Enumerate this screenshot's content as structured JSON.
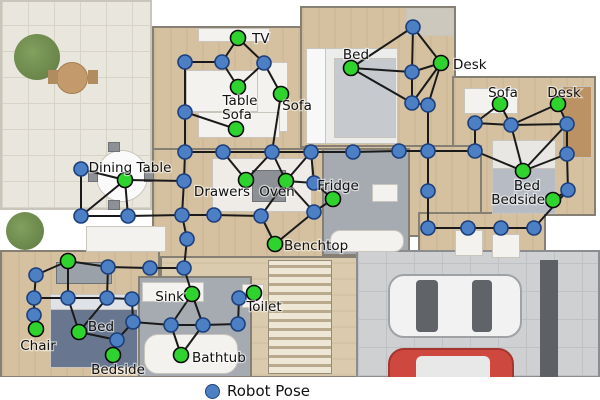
{
  "legend": {
    "label": "Robot Pose"
  },
  "colors": {
    "pose_fill": "#4d7fc4",
    "pose_stroke": "#1c3f7c",
    "landmark_fill": "#2ed32e",
    "landmark_stroke": "#0a0a0a",
    "edge": "#1a1a1a",
    "label_color": "#111111"
  },
  "graph": {
    "nodes": [
      {
        "id": "p1",
        "x": 185,
        "y": 62,
        "type": "pose"
      },
      {
        "id": "p2",
        "x": 222,
        "y": 62,
        "type": "pose"
      },
      {
        "id": "p3",
        "x": 264,
        "y": 63,
        "type": "pose"
      },
      {
        "id": "p4",
        "x": 185,
        "y": 112,
        "type": "pose"
      },
      {
        "id": "p5",
        "x": 81,
        "y": 169,
        "type": "pose"
      },
      {
        "id": "p6",
        "x": 81,
        "y": 216,
        "type": "pose"
      },
      {
        "id": "p7",
        "x": 128,
        "y": 216,
        "type": "pose"
      },
      {
        "id": "p8",
        "x": 185,
        "y": 152,
        "type": "pose"
      },
      {
        "id": "p9",
        "x": 184,
        "y": 181,
        "type": "pose"
      },
      {
        "id": "p10",
        "x": 182,
        "y": 215,
        "type": "pose"
      },
      {
        "id": "p11",
        "x": 187,
        "y": 239,
        "type": "pose"
      },
      {
        "id": "p12",
        "x": 150,
        "y": 268,
        "type": "pose"
      },
      {
        "id": "p13",
        "x": 184,
        "y": 268,
        "type": "pose"
      },
      {
        "id": "p14",
        "x": 223,
        "y": 152,
        "type": "pose"
      },
      {
        "id": "p15",
        "x": 272,
        "y": 152,
        "type": "pose"
      },
      {
        "id": "p16",
        "x": 311,
        "y": 152,
        "type": "pose"
      },
      {
        "id": "p17",
        "x": 353,
        "y": 152,
        "type": "pose"
      },
      {
        "id": "p18",
        "x": 399,
        "y": 151,
        "type": "pose"
      },
      {
        "id": "p19",
        "x": 428,
        "y": 151,
        "type": "pose"
      },
      {
        "id": "p20",
        "x": 475,
        "y": 151,
        "type": "pose"
      },
      {
        "id": "p21",
        "x": 214,
        "y": 215,
        "type": "pose"
      },
      {
        "id": "p22",
        "x": 261,
        "y": 216,
        "type": "pose"
      },
      {
        "id": "p23",
        "x": 314,
        "y": 183,
        "type": "pose"
      },
      {
        "id": "p24",
        "x": 314,
        "y": 212,
        "type": "pose"
      },
      {
        "id": "p25",
        "x": 171,
        "y": 325,
        "type": "pose"
      },
      {
        "id": "p26",
        "x": 203,
        "y": 325,
        "type": "pose"
      },
      {
        "id": "p27",
        "x": 238,
        "y": 324,
        "type": "pose"
      },
      {
        "id": "p28",
        "x": 239,
        "y": 298,
        "type": "pose"
      },
      {
        "id": "p29",
        "x": 36,
        "y": 275,
        "type": "pose"
      },
      {
        "id": "p30",
        "x": 108,
        "y": 267,
        "type": "pose"
      },
      {
        "id": "p31",
        "x": 34,
        "y": 298,
        "type": "pose"
      },
      {
        "id": "p32",
        "x": 68,
        "y": 298,
        "type": "pose"
      },
      {
        "id": "p33",
        "x": 107,
        "y": 298,
        "type": "pose"
      },
      {
        "id": "p34",
        "x": 132,
        "y": 299,
        "type": "pose"
      },
      {
        "id": "p35",
        "x": 34,
        "y": 315,
        "type": "pose"
      },
      {
        "id": "p36",
        "x": 133,
        "y": 322,
        "type": "pose"
      },
      {
        "id": "p37",
        "x": 117,
        "y": 340,
        "type": "pose"
      },
      {
        "id": "p38",
        "x": 413,
        "y": 27,
        "type": "pose"
      },
      {
        "id": "p39",
        "x": 412,
        "y": 72,
        "type": "pose"
      },
      {
        "id": "p40",
        "x": 412,
        "y": 103,
        "type": "pose"
      },
      {
        "id": "p41",
        "x": 428,
        "y": 105,
        "type": "pose"
      },
      {
        "id": "p42",
        "x": 475,
        "y": 123,
        "type": "pose"
      },
      {
        "id": "p43",
        "x": 511,
        "y": 125,
        "type": "pose"
      },
      {
        "id": "p44",
        "x": 567,
        "y": 124,
        "type": "pose"
      },
      {
        "id": "p45",
        "x": 567,
        "y": 154,
        "type": "pose"
      },
      {
        "id": "p46",
        "x": 568,
        "y": 190,
        "type": "pose"
      },
      {
        "id": "p47",
        "x": 428,
        "y": 191,
        "type": "pose"
      },
      {
        "id": "p48",
        "x": 428,
        "y": 228,
        "type": "pose"
      },
      {
        "id": "p49",
        "x": 468,
        "y": 228,
        "type": "pose"
      },
      {
        "id": "p50",
        "x": 501,
        "y": 228,
        "type": "pose"
      },
      {
        "id": "p51",
        "x": 534,
        "y": 228,
        "type": "pose"
      },
      {
        "id": "L1",
        "x": 238,
        "y": 38,
        "type": "landmark",
        "label": "TV",
        "lx": 252,
        "ly": 43,
        "anchor": "start"
      },
      {
        "id": "L2",
        "x": 238,
        "y": 87,
        "type": "landmark",
        "label": "Table",
        "lx": 240,
        "ly": 105,
        "anchor": "middle"
      },
      {
        "id": "L3",
        "x": 281,
        "y": 94,
        "type": "landmark",
        "label": "Sofa",
        "lx": 297,
        "ly": 110,
        "anchor": "middle"
      },
      {
        "id": "L4",
        "x": 236,
        "y": 129,
        "type": "landmark",
        "label": "Sofa",
        "lx": 237,
        "ly": 119,
        "anchor": "middle"
      },
      {
        "id": "L5",
        "x": 125,
        "y": 180,
        "type": "landmark",
        "label": "Dining Table",
        "lx": 130,
        "ly": 172,
        "anchor": "middle"
      },
      {
        "id": "L6",
        "x": 246,
        "y": 180,
        "type": "landmark",
        "label": "Drawers",
        "lx": 222,
        "ly": 196,
        "anchor": "middle"
      },
      {
        "id": "L7",
        "x": 286,
        "y": 181,
        "type": "landmark",
        "label": "Oven",
        "lx": 277,
        "ly": 196,
        "anchor": "middle"
      },
      {
        "id": "L8",
        "x": 333,
        "y": 199,
        "type": "landmark",
        "label": "Fridge",
        "lx": 338,
        "ly": 190,
        "anchor": "middle"
      },
      {
        "id": "L9",
        "x": 275,
        "y": 244,
        "type": "landmark",
        "label": "Benchtop",
        "lx": 284,
        "ly": 250,
        "anchor": "start"
      },
      {
        "id": "L10",
        "x": 192,
        "y": 294,
        "type": "landmark",
        "label": "Sink",
        "lx": 184,
        "ly": 301,
        "anchor": "end"
      },
      {
        "id": "L11",
        "x": 254,
        "y": 293,
        "type": "landmark",
        "label": "Toilet",
        "lx": 264,
        "ly": 311,
        "anchor": "middle"
      },
      {
        "id": "L12",
        "x": 181,
        "y": 355,
        "type": "landmark",
        "label": "Bathtub",
        "lx": 192,
        "ly": 362,
        "anchor": "start"
      },
      {
        "id": "L13",
        "x": 68,
        "y": 261,
        "type": "landmark",
        "label": "",
        "lx": 0,
        "ly": 0,
        "anchor": "middle"
      },
      {
        "id": "L14",
        "x": 36,
        "y": 329,
        "type": "landmark",
        "label": "Chair",
        "lx": 38,
        "ly": 350,
        "anchor": "middle"
      },
      {
        "id": "L15",
        "x": 79,
        "y": 332,
        "type": "landmark",
        "label": "Bed",
        "lx": 101,
        "ly": 331,
        "anchor": "middle"
      },
      {
        "id": "L16",
        "x": 113,
        "y": 355,
        "type": "landmark",
        "label": "Bedside",
        "lx": 118,
        "ly": 374,
        "anchor": "middle"
      },
      {
        "id": "L17",
        "x": 351,
        "y": 68,
        "type": "landmark",
        "label": "Bed",
        "lx": 356,
        "ly": 59,
        "anchor": "middle"
      },
      {
        "id": "L18",
        "x": 441,
        "y": 63,
        "type": "landmark",
        "label": "Desk",
        "lx": 453,
        "ly": 69,
        "anchor": "start"
      },
      {
        "id": "L19",
        "x": 500,
        "y": 104,
        "type": "landmark",
        "label": "Sofa",
        "lx": 503,
        "ly": 97,
        "anchor": "middle"
      },
      {
        "id": "L20",
        "x": 558,
        "y": 104,
        "type": "landmark",
        "label": "Desk",
        "lx": 564,
        "ly": 97,
        "anchor": "middle"
      },
      {
        "id": "L21",
        "x": 523,
        "y": 171,
        "type": "landmark",
        "label": "Bed",
        "lx": 527,
        "ly": 190,
        "anchor": "middle"
      },
      {
        "id": "L22",
        "x": 553,
        "y": 200,
        "type": "landmark",
        "label": "Bedside",
        "lx": 545,
        "ly": 204,
        "anchor": "end"
      }
    ],
    "edges": [
      [
        "p2",
        "L1"
      ],
      [
        "p3",
        "L1"
      ],
      [
        "p1",
        "p2"
      ],
      [
        "p2",
        "L2"
      ],
      [
        "p3",
        "L2"
      ],
      [
        "p3",
        "L3"
      ],
      [
        "p1",
        "p4"
      ],
      [
        "p4",
        "L4"
      ],
      [
        "p4",
        "p8"
      ],
      [
        "L3",
        "p15"
      ],
      [
        "p5",
        "L5"
      ],
      [
        "p5",
        "p6"
      ],
      [
        "p6",
        "p7"
      ],
      [
        "p6",
        "L5"
      ],
      [
        "p7",
        "L5"
      ],
      [
        "L5",
        "p9"
      ],
      [
        "p7",
        "p10"
      ],
      [
        "p8",
        "p9"
      ],
      [
        "p9",
        "p10"
      ],
      [
        "p10",
        "p11"
      ],
      [
        "p11",
        "p13"
      ],
      [
        "p8",
        "p14"
      ],
      [
        "p14",
        "p15"
      ],
      [
        "p15",
        "p16"
      ],
      [
        "p16",
        "p17"
      ],
      [
        "p17",
        "p18"
      ],
      [
        "p18",
        "p19"
      ],
      [
        "p19",
        "p20"
      ],
      [
        "p14",
        "L6"
      ],
      [
        "p15",
        "L6"
      ],
      [
        "p15",
        "L7"
      ],
      [
        "p16",
        "L7"
      ],
      [
        "L7",
        "p23"
      ],
      [
        "L7",
        "p22"
      ],
      [
        "L7",
        "p24"
      ],
      [
        "p16",
        "p23"
      ],
      [
        "p23",
        "L8"
      ],
      [
        "p24",
        "L8"
      ],
      [
        "p22",
        "L9"
      ],
      [
        "p24",
        "L9"
      ],
      [
        "p10",
        "p21"
      ],
      [
        "p21",
        "p22"
      ],
      [
        "p12",
        "p13"
      ],
      [
        "p12",
        "p30"
      ],
      [
        "p13",
        "L10"
      ],
      [
        "L10",
        "p25"
      ],
      [
        "L10",
        "p26"
      ],
      [
        "p25",
        "p26"
      ],
      [
        "p25",
        "L12"
      ],
      [
        "p26",
        "L12"
      ],
      [
        "p26",
        "p27"
      ],
      [
        "p27",
        "p28"
      ],
      [
        "p28",
        "L11"
      ],
      [
        "p36",
        "p25"
      ],
      [
        "L13",
        "p29"
      ],
      [
        "L13",
        "p30"
      ],
      [
        "L13",
        "p32"
      ],
      [
        "p29",
        "p31"
      ],
      [
        "p31",
        "p32"
      ],
      [
        "p32",
        "p33"
      ],
      [
        "p33",
        "p30"
      ],
      [
        "p33",
        "p34"
      ],
      [
        "p31",
        "p35"
      ],
      [
        "p35",
        "L14"
      ],
      [
        "p32",
        "L15"
      ],
      [
        "p33",
        "L15"
      ],
      [
        "p34",
        "p36"
      ],
      [
        "p36",
        "p37"
      ],
      [
        "p37",
        "L16"
      ],
      [
        "L15",
        "p37"
      ],
      [
        "L17",
        "p38"
      ],
      [
        "L17",
        "p39"
      ],
      [
        "L17",
        "p40"
      ],
      [
        "p38",
        "p39"
      ],
      [
        "p38",
        "L18"
      ],
      [
        "p39",
        "L18"
      ],
      [
        "p39",
        "p40"
      ],
      [
        "p40",
        "L18"
      ],
      [
        "p40",
        "p41"
      ],
      [
        "p41",
        "L18"
      ],
      [
        "p41",
        "p19"
      ],
      [
        "L19",
        "p42"
      ],
      [
        "L19",
        "p43"
      ],
      [
        "p42",
        "p43"
      ],
      [
        "p43",
        "L20"
      ],
      [
        "p43",
        "p44"
      ],
      [
        "L20",
        "p44"
      ],
      [
        "p42",
        "p20"
      ],
      [
        "p20",
        "L21"
      ],
      [
        "p43",
        "L21"
      ],
      [
        "p44",
        "L21"
      ],
      [
        "p45",
        "L21"
      ],
      [
        "p44",
        "p45"
      ],
      [
        "p45",
        "p46"
      ],
      [
        "p46",
        "L22"
      ],
      [
        "p46",
        "p51"
      ],
      [
        "p19",
        "p47"
      ],
      [
        "p47",
        "p48"
      ],
      [
        "p48",
        "p49"
      ],
      [
        "p49",
        "p50"
      ],
      [
        "p50",
        "p51"
      ]
    ]
  }
}
